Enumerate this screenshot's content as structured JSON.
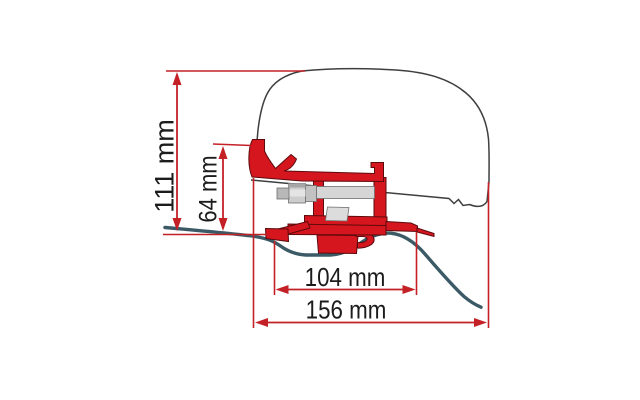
{
  "diagram": {
    "type": "technical-dimension-drawing",
    "subject": "awning adapter bracket mounted on van roof cross-section",
    "labels": {
      "total_height": "111 mm",
      "bracket_height": "64 mm",
      "bracket_width": "104 mm",
      "overall_width": "156 mm"
    },
    "dimensions": [
      {
        "name": "total height from roof sheet to vehicle top",
        "value": "111 mm",
        "orientation": "vertical"
      },
      {
        "name": "bracket hook height above roof sheet",
        "value": "64 mm",
        "orientation": "vertical"
      },
      {
        "name": "bracket base width",
        "value": "104 mm",
        "orientation": "horizontal"
      },
      {
        "name": "overall width to vehicle side",
        "value": "156 mm",
        "orientation": "horizontal"
      }
    ],
    "colors": {
      "dimension_red": "#c42127",
      "bracket_red": "#d6161e",
      "roof_profile_teal": "#3b5a66",
      "vehicle_outline_gray": "#3f3f3f",
      "metal_gray": "#cdcdcd",
      "background": "#ffffff"
    }
  }
}
